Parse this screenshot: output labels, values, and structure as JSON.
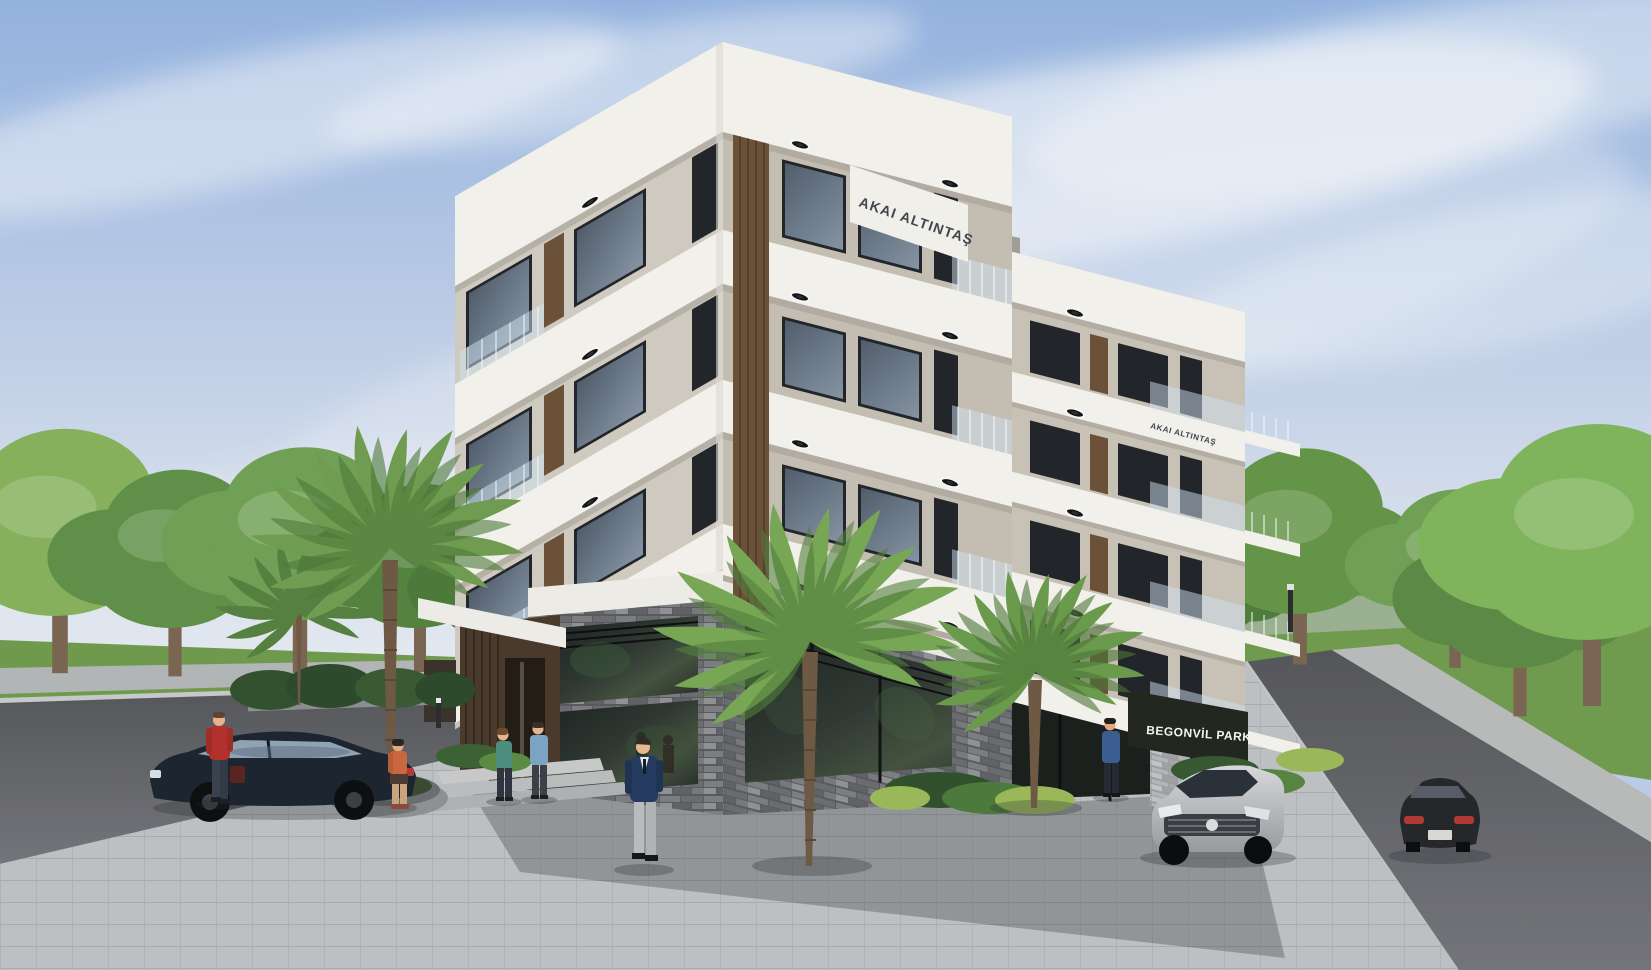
{
  "scene": {
    "type": "architectural-exterior-render",
    "setting": "daytime street corner, landscaped sidewalks, blue sky with wispy clouds",
    "signs": {
      "roof_sign": "AKAI ALTINTAŞ",
      "wing_roof_sign": "AKAI ALTINTAŞ",
      "entrance_sign": "BEGONVİL PARK"
    },
    "building": {
      "name": "Begonvil Park",
      "residential_floors": 5,
      "ground_floor": "double-height commercial space with dark ledgestone cladding and full-height glazing",
      "facade_features": [
        "white wrap-around balcony slabs",
        "warm grey walls",
        "dark bronze framed windows",
        "vertical walnut louvre strips",
        "frameless glass balustrades",
        "round recessed soffit downlights"
      ]
    },
    "vehicles": [
      {
        "name": "dark-sedan-parked",
        "color": "#1d2531",
        "position": "left street"
      },
      {
        "name": "silver-sedan",
        "color": "#c0c3c7",
        "position": "driveway right of building"
      },
      {
        "name": "dark-sedan-driving-away",
        "color": "#26272b",
        "position": "right street"
      }
    ],
    "people": [
      {
        "name": "man-red-jacket-with-briefcase",
        "color": "#b3312d"
      },
      {
        "name": "woman-sitting-on-planter",
        "color": "#c96840"
      },
      {
        "name": "woman-teal-top",
        "color": "#4c8d7e"
      },
      {
        "name": "man-light-blue-shirt",
        "color": "#7da3c4"
      },
      {
        "name": "man-navy-suit",
        "color": "#243a5e"
      },
      {
        "name": "person-blue-jacket-at-entrance",
        "color": "#3c5d8f"
      }
    ],
    "vegetation": {
      "palm_trees": 4,
      "street_trees": "rows along both streets",
      "planting": "ferns and shrubs in grey planters, round concrete planter bench"
    },
    "palette": {
      "sky_top": "#93b2de",
      "sky_horizon": "#e9edf2",
      "slab_white": "#f1f0ea",
      "wall_beige": "#cfcabf",
      "wood_louvre": "#6b5138",
      "stone_dark": "#585a5e",
      "shop_glass": "#2f3833",
      "road": "#636468",
      "paver": "#bdc0c2",
      "grass": "#6f9a4e",
      "tree_green": "#6fa055"
    }
  }
}
